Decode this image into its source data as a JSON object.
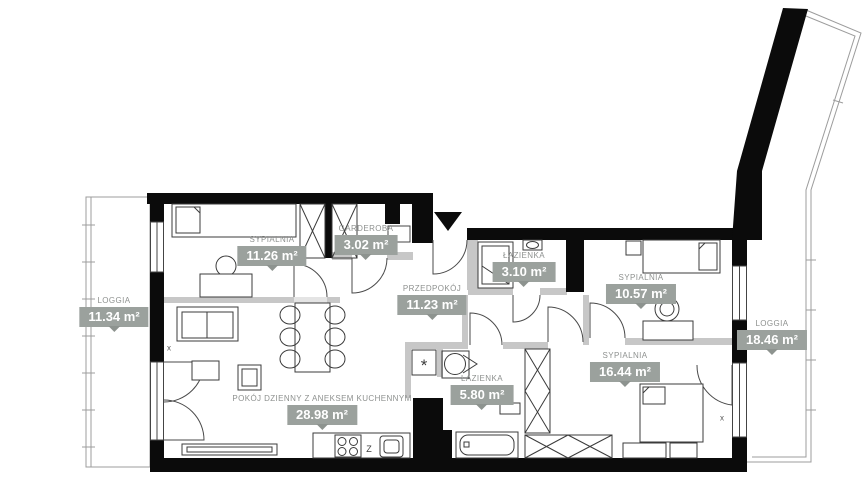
{
  "plan_title": "Apartment floor plan",
  "rooms": [
    {
      "name": "SYPIALNIA",
      "area": "11.26 m²"
    },
    {
      "name": "GARDEROBA",
      "area": "3.02 m²"
    },
    {
      "name": "ŁAZIENKA",
      "area": "3.10 m²"
    },
    {
      "name": "SYPIALNIA",
      "area": "10.57 m²"
    },
    {
      "name": "LOGGIA",
      "area": "11.34 m²"
    },
    {
      "name": "PRZEDPOKÓJ",
      "area": "11.23 m²"
    },
    {
      "name": "LOGGIA",
      "area": "18.46 m²"
    },
    {
      "name": "SYPIALNIA",
      "area": "16.44 m²"
    },
    {
      "name": "ŁAZIENKA",
      "area": "5.80 m²"
    },
    {
      "name": "POKÓJ DZIENNY Z ANEKSEM KUCHENNYM",
      "area": "28.98 m²"
    }
  ],
  "markers": {
    "kitchen_z": "Z",
    "washing_machine": "*",
    "window_marker_left": "x",
    "window_marker_right": "x"
  },
  "colors": {
    "wall": "#0b0b0b",
    "partition": "#c7c7c7",
    "badge_bg": "#9ba19d",
    "badge_tail": "#8d938f",
    "badge_text": "#ffffff",
    "room_name_text": "#8e918f",
    "loggia_line": "#9c9c9c"
  }
}
